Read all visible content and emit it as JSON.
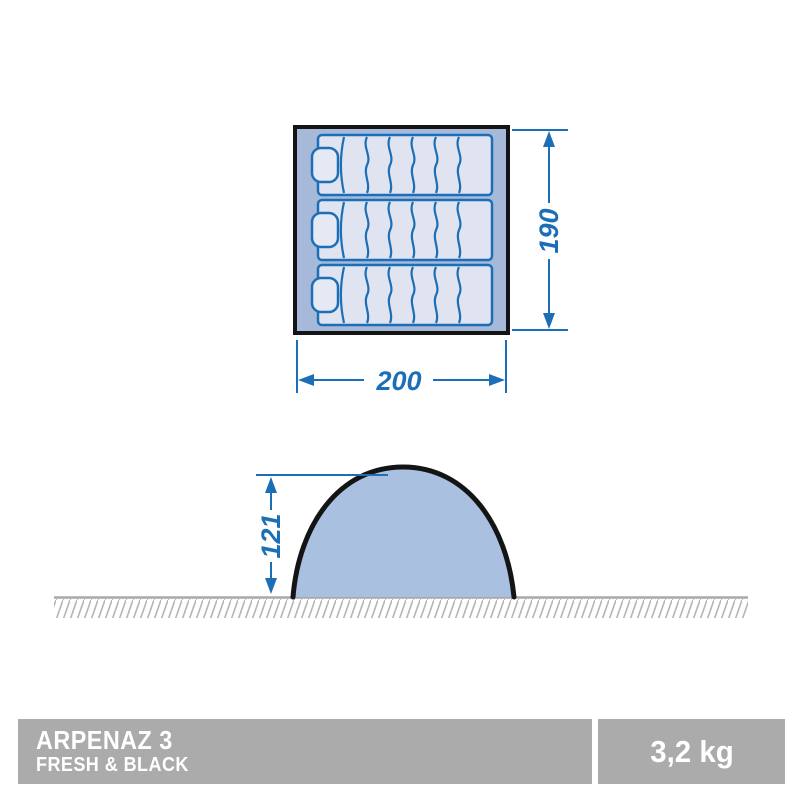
{
  "floorplan": {
    "depth_label": "190",
    "width_label": "200",
    "mat_count": 3
  },
  "side_view": {
    "height_label": "121"
  },
  "footer": {
    "product_line1": "ARPENAZ 3",
    "product_line2": "FRESH & BLACK",
    "weight_label": "3,2 kg"
  },
  "colors": {
    "dimension_blue": "#1c6fb7",
    "mat_fill": "#dfe4f0",
    "floor_band_blue": "#a6b9d8",
    "dome_fill": "#a9c0e1",
    "outline_black": "#141414",
    "ground_gray": "#a8a8a8",
    "bar_gray": "#ababab",
    "text_white": "#ffffff"
  }
}
